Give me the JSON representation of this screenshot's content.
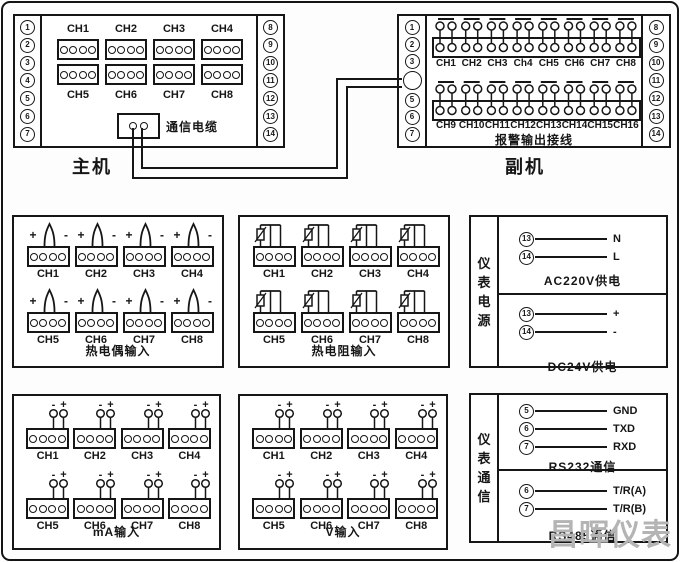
{
  "host": {
    "title": "主机",
    "left_terminals": [
      "1",
      "2",
      "3",
      "4",
      "5",
      "6",
      "7"
    ],
    "right_terminals": [
      "8",
      "9",
      "10",
      "11",
      "12",
      "13",
      "14"
    ],
    "channels_top": [
      "CH1",
      "CH2",
      "CH3",
      "CH4"
    ],
    "channels_bottom": [
      "CH5",
      "CH6",
      "CH7",
      "CH8"
    ],
    "cable_label": "通信电缆"
  },
  "sub": {
    "title": "副机",
    "left_terminals": [
      "1",
      "2",
      "3",
      "",
      "5",
      "6",
      "7"
    ],
    "right_terminals": [
      "8",
      "9",
      "10",
      "11",
      "12",
      "13",
      "14"
    ],
    "group1_channels": [
      "CH1",
      "CH2",
      "CH3",
      "Ch4",
      "CH5",
      "CH6",
      "CH7",
      "CH8"
    ],
    "group2_channels": [
      "CH9",
      "CH10",
      "CH11",
      "CH12",
      "CH13",
      "CH14",
      "CH15",
      "CH16"
    ],
    "caption": "报警输出接线"
  },
  "input_panels": [
    {
      "id": "tc",
      "caption": "热电偶输入",
      "symbol": "thermocouple",
      "channels": [
        "CH1",
        "CH2",
        "CH3",
        "CH4",
        "CH5",
        "CH6",
        "CH7",
        "CH8"
      ]
    },
    {
      "id": "rtd",
      "caption": "热电阻输入",
      "symbol": "rtd",
      "channels": [
        "CH1",
        "CH2",
        "CH3",
        "CH4",
        "CH5",
        "CH6",
        "CH7",
        "CH8"
      ]
    },
    {
      "id": "ma",
      "caption": "mA输入",
      "symbol": "polarity",
      "channels": [
        "CH1",
        "CH2",
        "CH3",
        "CH4",
        "CH5",
        "CH6",
        "CH7",
        "CH8"
      ]
    },
    {
      "id": "v",
      "caption": "V输入",
      "symbol": "polarity",
      "channels": [
        "CH1",
        "CH2",
        "CH3",
        "CH4",
        "CH5",
        "CH6",
        "CH7",
        "CH8"
      ]
    }
  ],
  "power": {
    "side_label": "仪表电源",
    "sections": [
      {
        "caption": "AC220V供电",
        "rows": [
          {
            "terminal": "13",
            "label": "N"
          },
          {
            "terminal": "14",
            "label": "L"
          }
        ]
      },
      {
        "caption": "DC24V供电",
        "rows": [
          {
            "terminal": "13",
            "label": "+"
          },
          {
            "terminal": "14",
            "label": "-"
          }
        ]
      }
    ]
  },
  "comm": {
    "side_label": "仪表通信",
    "sections": [
      {
        "caption": "RS232通信",
        "rows": [
          {
            "terminal": "5",
            "label": "GND"
          },
          {
            "terminal": "6",
            "label": "TXD"
          },
          {
            "terminal": "7",
            "label": "RXD"
          }
        ]
      },
      {
        "caption": "RS485通信",
        "rows": [
          {
            "terminal": "6",
            "label": "T/R(A)"
          },
          {
            "terminal": "7",
            "label": "T/R(B)"
          }
        ]
      }
    ]
  },
  "symbols": {
    "plus": "+",
    "minus": "-"
  },
  "watermark": "昌晖仪表",
  "colors": {
    "line": "#161616",
    "watermark": "#b4b4b4",
    "background": "#ffffff"
  }
}
